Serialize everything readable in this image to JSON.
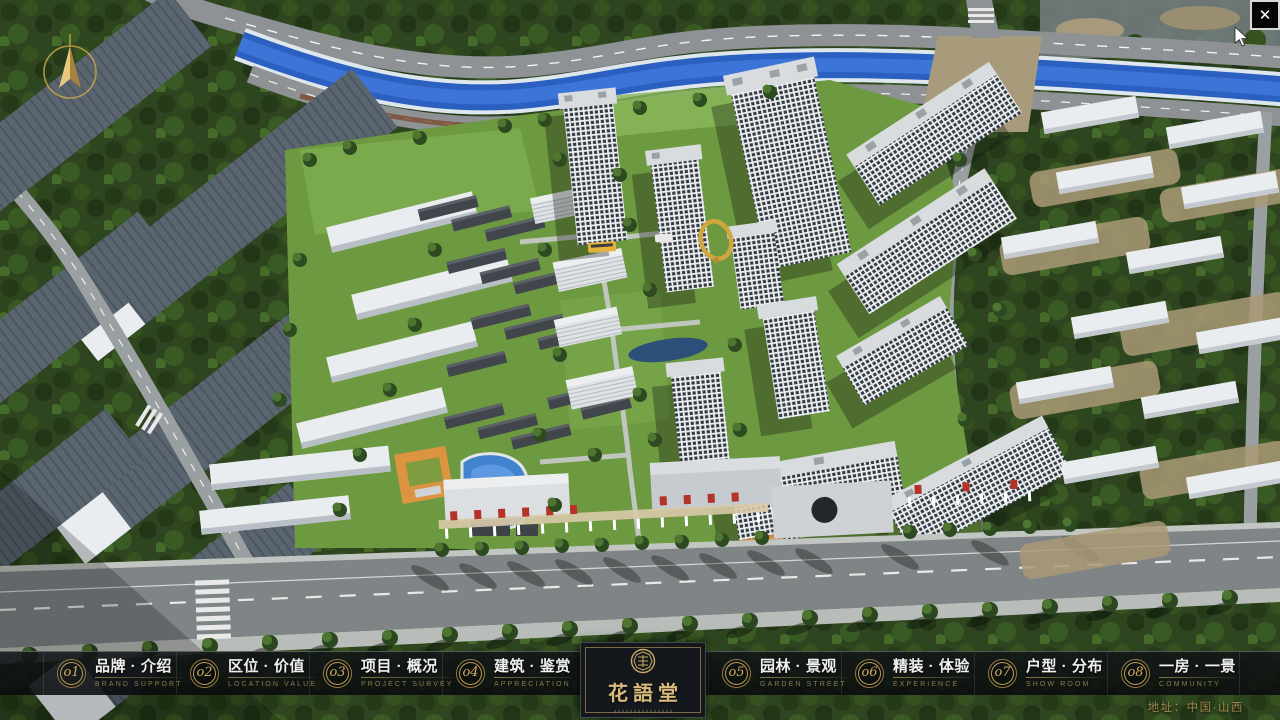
{
  "window": {
    "close_icon": "✕"
  },
  "hud": {
    "address": "地址：中国·山西"
  },
  "logo": {
    "title": "花語堂"
  },
  "colors": {
    "accent_gold": "#bd9c5c",
    "river_blue": "#2b5fc0",
    "navbar_bg": "rgba(13,17,19,0.85)"
  },
  "nav": {
    "items": [
      {
        "num": "o1",
        "title": "品牌 · 介绍",
        "subtitle": "BRAND SUPPORT"
      },
      {
        "num": "o2",
        "title": "区位 · 价值",
        "subtitle": "LOCATION VALUE"
      },
      {
        "num": "o3",
        "title": "项目 · 概况",
        "subtitle": "PROJECT SURVEY"
      },
      {
        "num": "o4",
        "title": "建筑 · 鉴赏",
        "subtitle": "APPRECIATION"
      },
      {
        "num": "o5",
        "title": "园林 · 景观",
        "subtitle": "GARDEN STREET"
      },
      {
        "num": "o6",
        "title": "精装 · 体验",
        "subtitle": "EXPERIENCE"
      },
      {
        "num": "o7",
        "title": "户型 · 分布",
        "subtitle": "SHOW ROOM"
      },
      {
        "num": "o8",
        "title": "一房 · 一景",
        "subtitle": "COMMUNITY"
      }
    ]
  }
}
